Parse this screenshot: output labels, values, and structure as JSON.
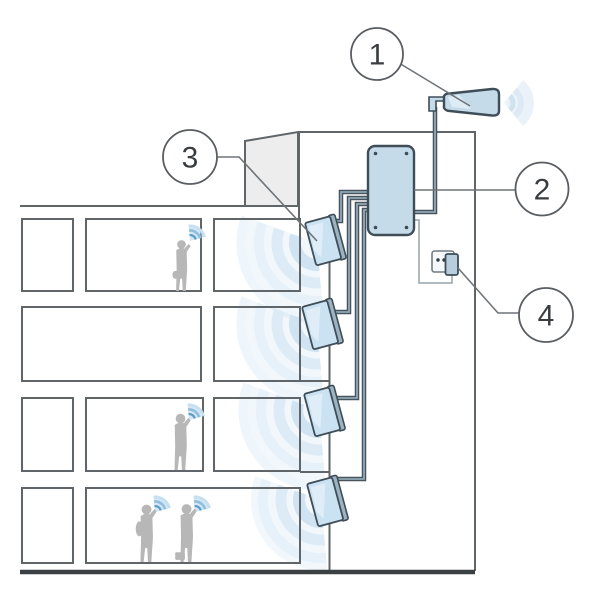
{
  "diagram": {
    "callouts": [
      {
        "number": "1",
        "target": "outdoor-antenna"
      },
      {
        "number": "2",
        "target": "repeater-amplifier"
      },
      {
        "number": "3",
        "target": "indoor-antenna"
      },
      {
        "number": "4",
        "target": "power-outlet"
      }
    ],
    "palette": {
      "device_fill": "#c6dbea",
      "panel_fill": "#cbe2f2",
      "outline": "#3e4d57",
      "line_gray": "#5f6569",
      "ground": "#3b4043",
      "wave_blue": "#cfe3f2",
      "phone_wave_blue": "#5b9dcc",
      "silhouette": "#b7b7b7",
      "background": "#ffffff"
    }
  }
}
